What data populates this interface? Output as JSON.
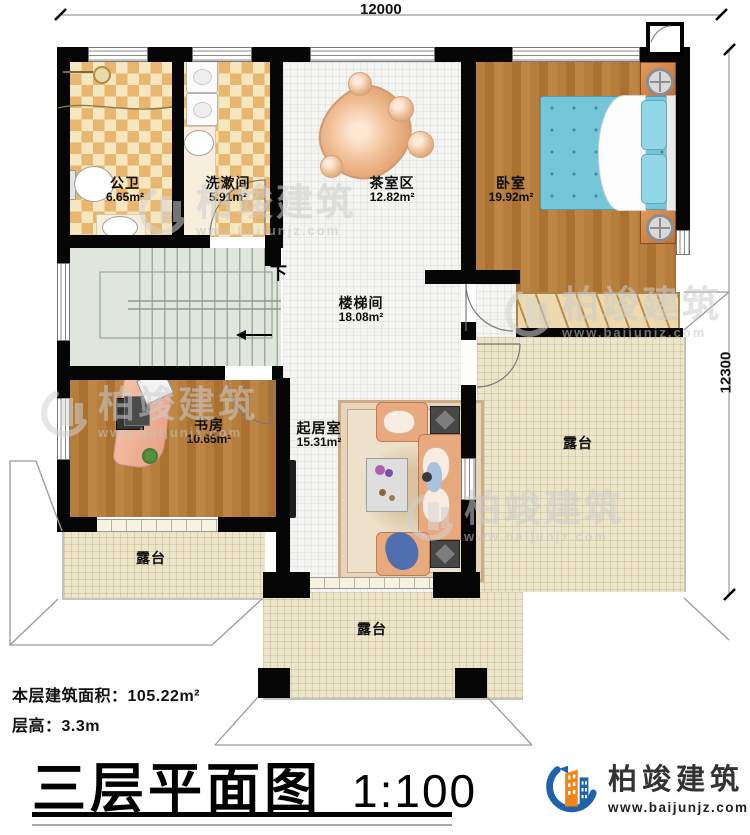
{
  "dimensions": {
    "top": "12000",
    "right": "12300"
  },
  "stairs": {
    "down": "下"
  },
  "rooms": [
    {
      "name": "公卫",
      "area": "6.65m²"
    },
    {
      "name": "洗漱间",
      "area": "5.91m²"
    },
    {
      "name": "茶室区",
      "area": "12.82m²"
    },
    {
      "name": "卧室",
      "area": "19.92m²"
    },
    {
      "name": "楼梯间",
      "area": "18.08m²"
    },
    {
      "name": "书房",
      "area": "10.65m²"
    },
    {
      "name": "起居室",
      "area": "15.31m²"
    }
  ],
  "terrace_label": "露台",
  "info": {
    "area_label": "本层建筑面积：",
    "area_value": "105.22m²",
    "height_label": "层高：",
    "height_value": "3.3m"
  },
  "title": {
    "main": "三层平面图",
    "scale": "1:100"
  },
  "brand": {
    "name": "柏竣建筑",
    "site": "www.baijunjz.com"
  },
  "colors": {
    "wall": "#060606",
    "tile_light": "#f6e7c0",
    "tile_dark": "#e9b66f",
    "wood": "#b67e3c",
    "stair_floor": "#e0e6de",
    "corridor_floor": "#f4f4f2",
    "terrace_floor": "#ede5ca",
    "bed": "#76c6da",
    "sofa": "#e9a97e",
    "brand_blue": "#1e62ab",
    "brand_orange": "#f08519"
  }
}
